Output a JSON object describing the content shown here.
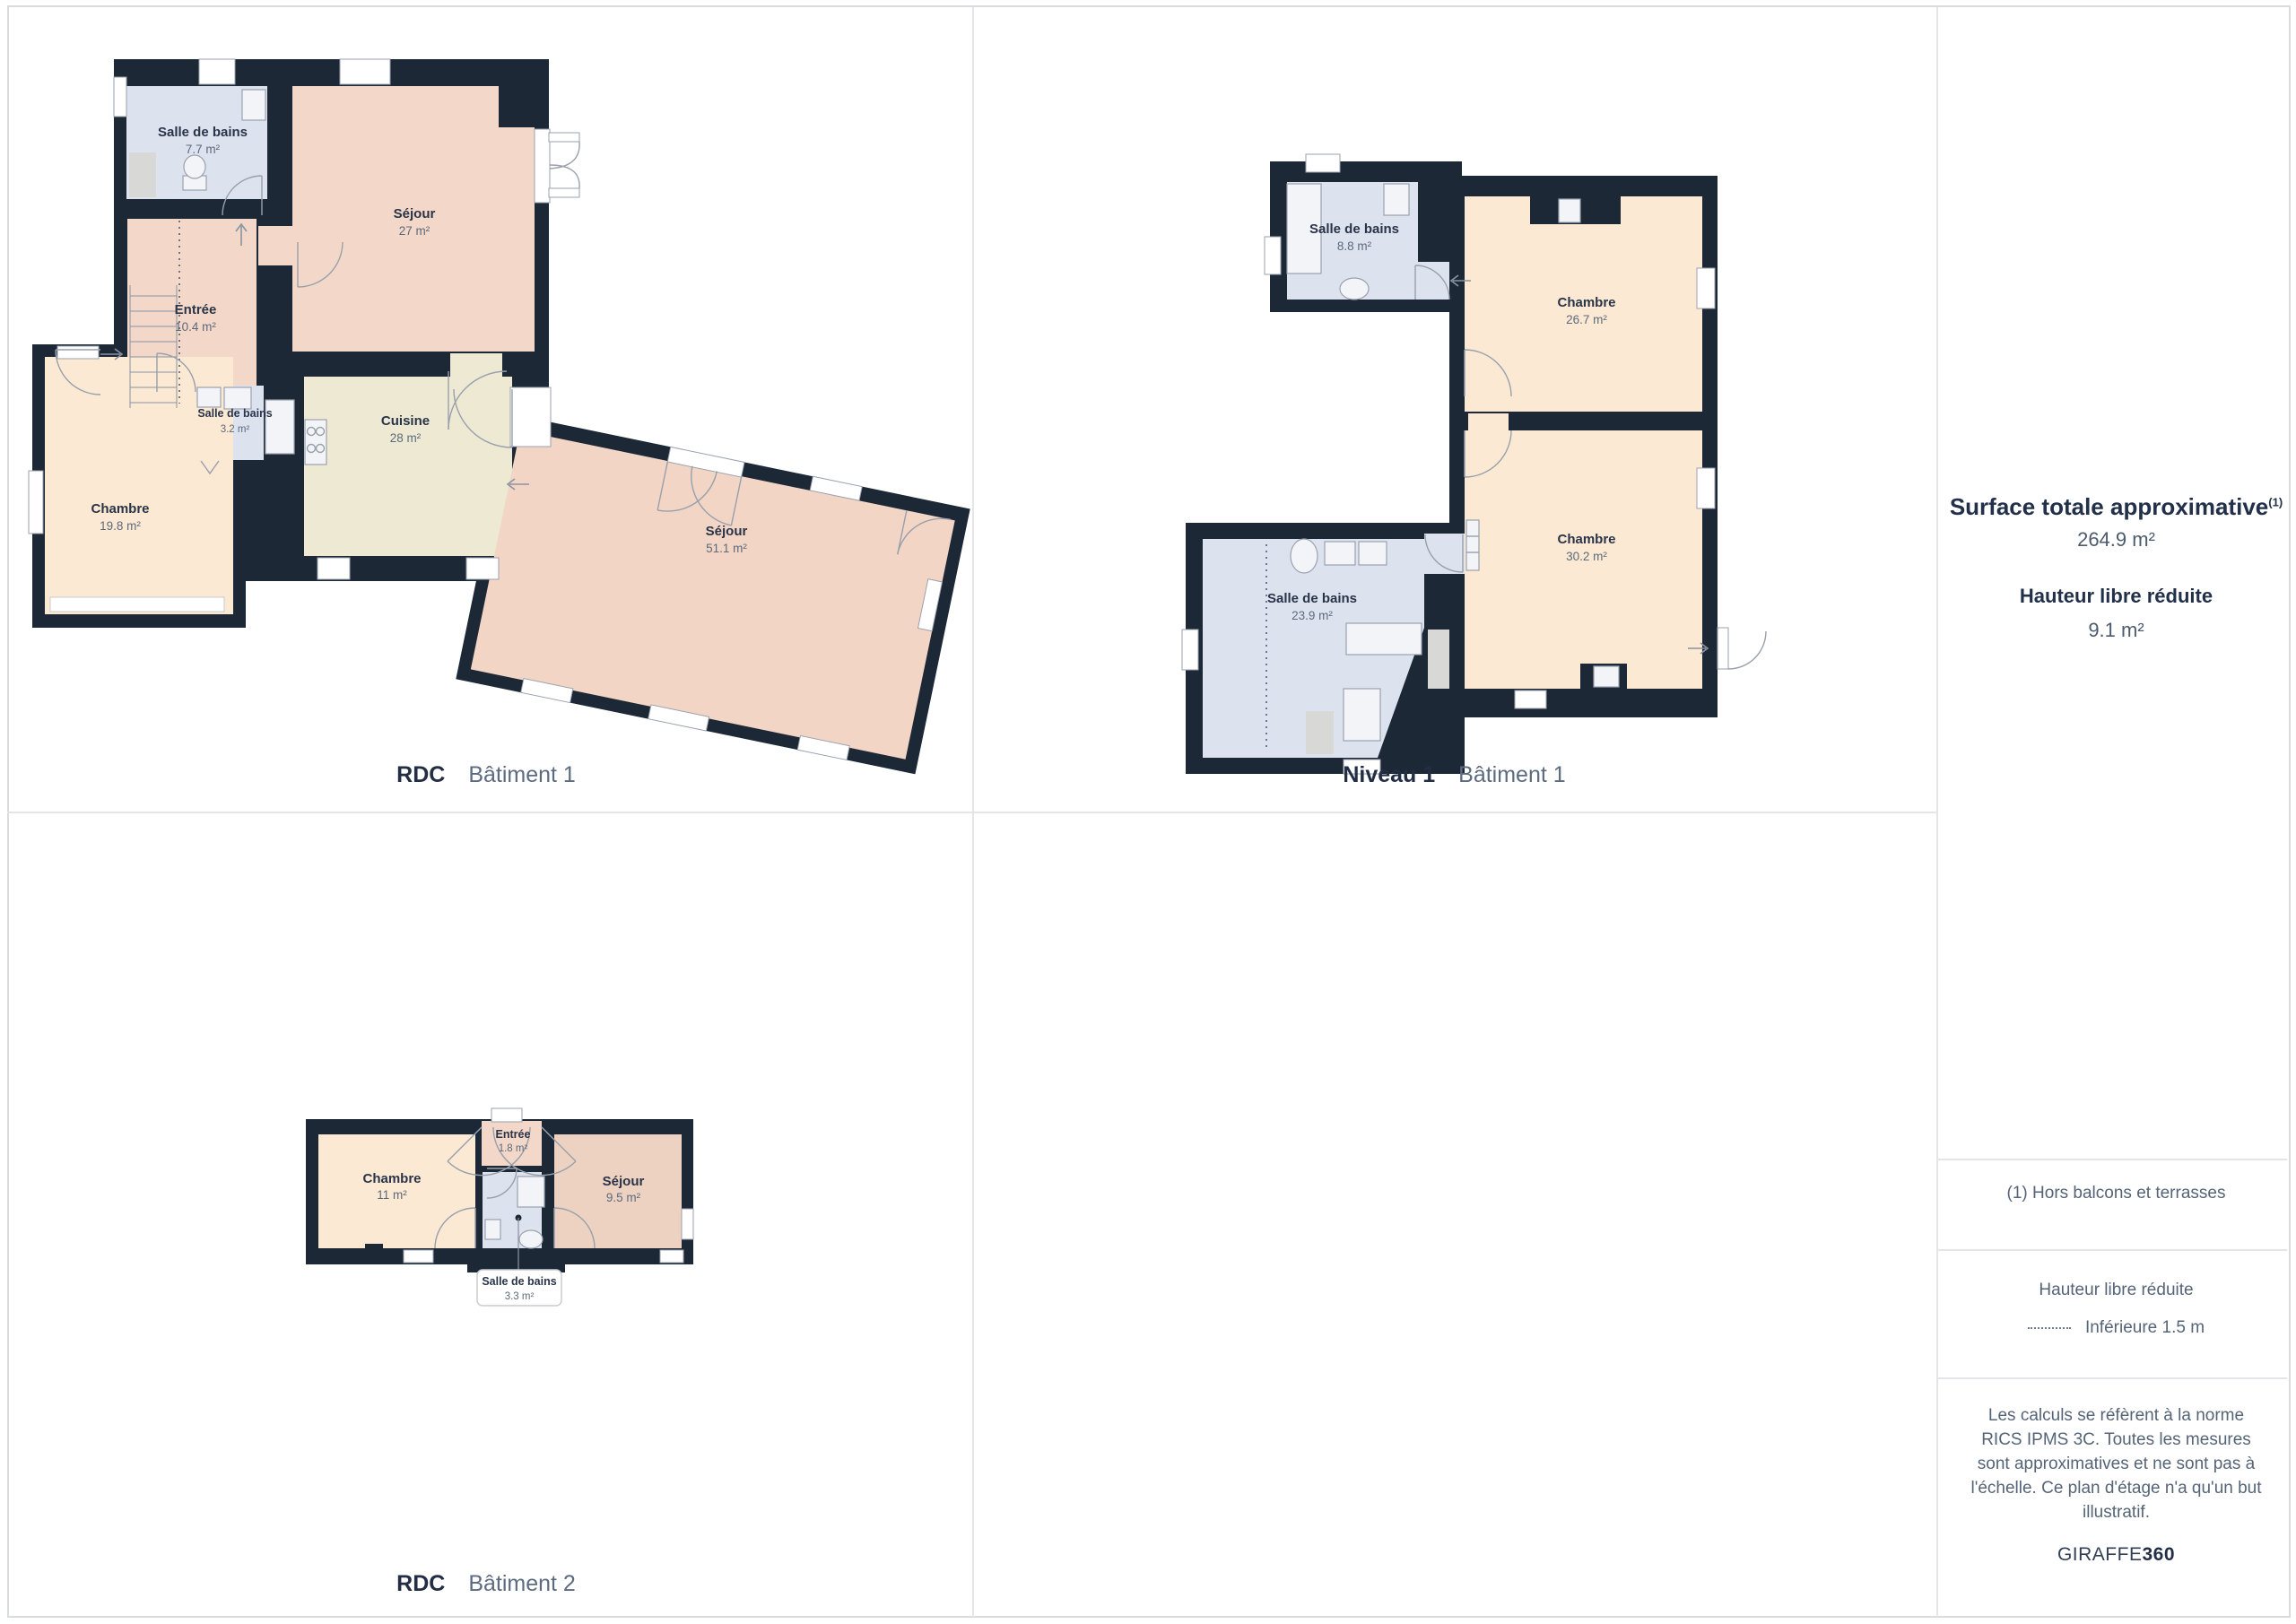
{
  "panels": [
    {
      "title_bold": "RDC",
      "title_light": "Bâtiment 1",
      "rooms": {
        "bath1": {
          "name": "Salle de bains",
          "area": "7.7 m²"
        },
        "sejour1": {
          "name": "Séjour",
          "area": "27 m²"
        },
        "entree": {
          "name": "Entrée",
          "area": "10.4 m²"
        },
        "bath2": {
          "name": "Salle de bains",
          "area": "3.2 m²"
        },
        "cuisine": {
          "name": "Cuisine",
          "area": "28 m²"
        },
        "chambre": {
          "name": "Chambre",
          "area": "19.8 m²"
        },
        "sejour2": {
          "name": "Séjour",
          "area": "51.1 m²"
        }
      }
    },
    {
      "title_bold": "Niveau 1",
      "title_light": "Bâtiment 1",
      "rooms": {
        "bath1": {
          "name": "Salle de bains",
          "area": "8.8 m²"
        },
        "chambre1": {
          "name": "Chambre",
          "area": "26.7 m²"
        },
        "chambre2": {
          "name": "Chambre",
          "area": "30.2 m²"
        },
        "bath2": {
          "name": "Salle de bains",
          "area": "23.9 m²"
        }
      }
    },
    {
      "title_bold": "RDC",
      "title_light": "Bâtiment 2",
      "rooms": {
        "chambre": {
          "name": "Chambre",
          "area": "11 m²"
        },
        "entree": {
          "name": "Entrée",
          "area": "1.8 m²"
        },
        "sejour": {
          "name": "Séjour",
          "area": "9.5 m²"
        },
        "bath": {
          "name": "Salle de bains",
          "area": "3.3 m²"
        }
      }
    }
  ],
  "sidebar": {
    "surface_title": "Surface totale approximative",
    "surface_sup": "(1)",
    "surface_value": "264.9 m²",
    "height_title": "Hauteur libre réduite",
    "height_value": "9.1 m²",
    "footnote": "(1) Hors balcons et terrasses",
    "legend_title": "Hauteur libre réduite",
    "legend_item": "Inférieure 1.5 m",
    "disclaimer": "Les calculs se réfèrent à la norme RICS IPMS 3C. Toutes les mesures sont approximatives et ne sont pas à l'échelle. Ce plan d'étage n'a qu'un but illustratif.",
    "brand_regular": "GIRAFFE",
    "brand_bold": "360"
  },
  "colors": {
    "wall": "#1d2837",
    "bathroom": "#dce2ee",
    "living": "#f3d7c8",
    "kitchen": "#eee9d3",
    "bedroom": "#fce9d3",
    "divider": "#e3e5e9"
  }
}
